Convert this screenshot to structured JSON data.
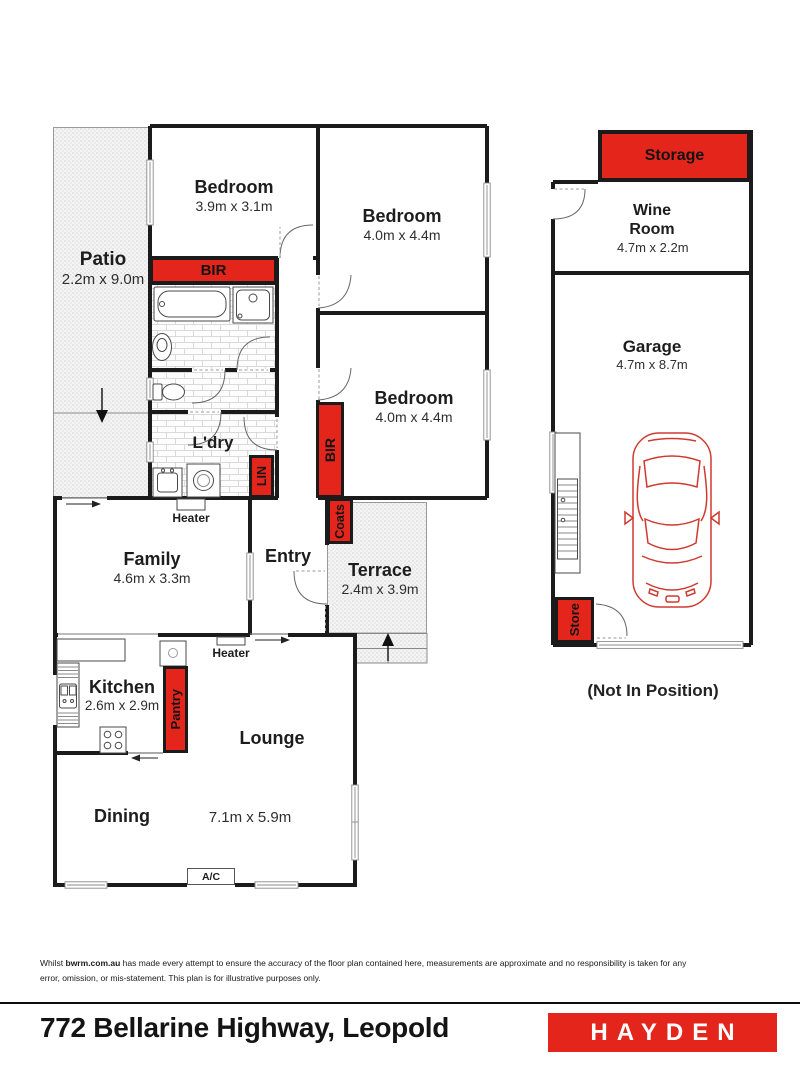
{
  "colors": {
    "accent_red": "#e4251b",
    "wall_black": "#1b1b1b"
  },
  "rooms": {
    "patio": {
      "name": "Patio",
      "dims": "2.2m x 9.0m"
    },
    "bedroom1": {
      "name": "Bedroom",
      "dims": "3.9m x 3.1m"
    },
    "bedroom2": {
      "name": "Bedroom",
      "dims": "4.0m x 4.4m"
    },
    "bedroom3": {
      "name": "Bedroom",
      "dims": "4.0m x 4.4m"
    },
    "laundry": {
      "name": "L'dry"
    },
    "family": {
      "name": "Family",
      "dims": "4.6m x 3.3m"
    },
    "entry": {
      "name": "Entry"
    },
    "terrace": {
      "name": "Terrace",
      "dims": "2.4m x 3.9m"
    },
    "kitchen": {
      "name": "Kitchen",
      "dims": "2.6m x 2.9m"
    },
    "lounge": {
      "name": "Lounge"
    },
    "dining": {
      "name": "Dining"
    },
    "lounge_dining_dims": "7.1m x 5.9m",
    "wine_room": {
      "name": "Wine Room",
      "dims": "4.7m x 2.2m"
    },
    "garage": {
      "name": "Garage",
      "dims": "4.7m x 8.7m"
    }
  },
  "closets": {
    "bir": "BIR",
    "lin": "LIN",
    "coats": "Coats",
    "pantry": "Pantry",
    "storage": "Storage",
    "store": "Store"
  },
  "labels": {
    "heater": "Heater",
    "ac": "A/C",
    "not_in_position": "(Not In Position)"
  },
  "footer": {
    "disclaimer_prefix": "Whilst ",
    "disclaimer_bold": "bwrm.com.au",
    "disclaimer_rest": " has made every attempt to ensure the accuracy of the floor plan contained here, measurements are approximate and no responsibility is taken for any error, omission, or mis-statement. This plan is for illustrative purposes only.",
    "address": "772 Bellarine Highway, Leopold",
    "brand": "HAYDEN"
  }
}
